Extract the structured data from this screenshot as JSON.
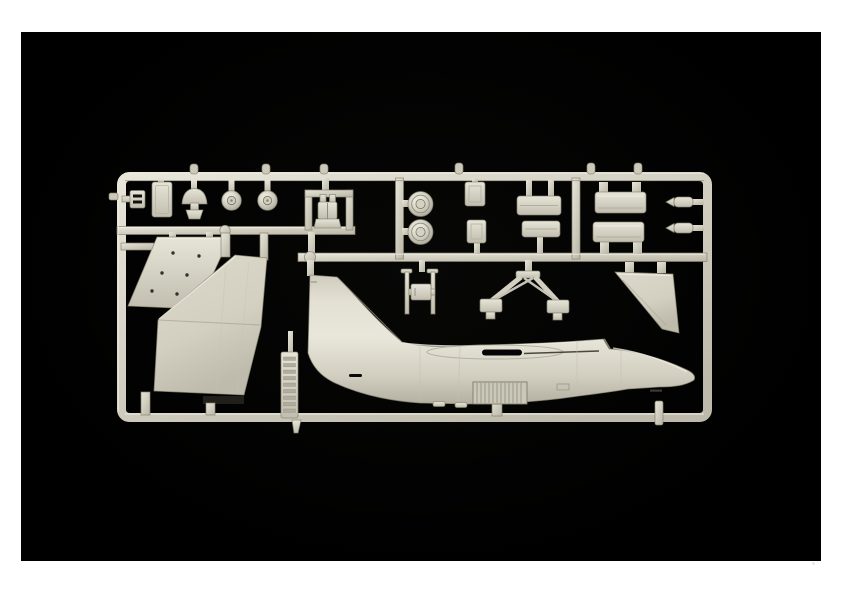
{
  "scene": {
    "type": "photograph",
    "description": "Photograph of a light grey injection-moulded plastic model kit sprue with aircraft parts (fuselage half, tail fin, wing panel, wheels, pylons and small detail parts) on a black background with a white margin",
    "background_color": "#000000",
    "margin_color": "#ffffff",
    "plastic_color": "#d8d5c7",
    "plastic_highlight": "#ece9dd",
    "plastic_shadow": "#a6a394"
  },
  "parts": {
    "runner_frame": {
      "label": "sprue runner frame"
    },
    "bracket_part": {
      "label": "small bracket part"
    },
    "blanking_plate": {
      "label": "small rectangular plate part"
    },
    "domed_part": {
      "label": "small domed part"
    },
    "small_wheel_1": {
      "label": "small wheel part"
    },
    "small_wheel_2": {
      "label": "small wheel part"
    },
    "ejection_seat": {
      "label": "ejection seat part in runner loop"
    },
    "flap_panel": {
      "label": "riveted wing panel part"
    },
    "vertical_tail": {
      "label": "large swept tail fin part"
    },
    "label_tab": {
      "label": "vertical tab with embossed moulded lettering (illegible)"
    },
    "fuselage": {
      "label": "aircraft fuselage half with integral tail fin, chin intake and nose"
    },
    "main_wheel_1": {
      "label": "main wheel part"
    },
    "main_wheel_2": {
      "label": "main wheel part"
    },
    "door_part_1": {
      "label": "small access door part"
    },
    "door_part_2": {
      "label": "small access door part"
    },
    "brake_door_1": {
      "label": "wide airbrake door part"
    },
    "brake_door_2": {
      "label": "wide airbrake door part"
    },
    "pylon_1": {
      "label": "stores pylon part"
    },
    "pylon_2": {
      "label": "stores pylon part"
    },
    "probe_1": {
      "label": "small probe part"
    },
    "probe_2": {
      "label": "small probe part"
    },
    "cross_part": {
      "label": "cross-frame actuator part"
    },
    "gear_brace": {
      "label": "landing gear brace frame part"
    },
    "rudder_fin": {
      "label": "small swept fin part"
    }
  }
}
